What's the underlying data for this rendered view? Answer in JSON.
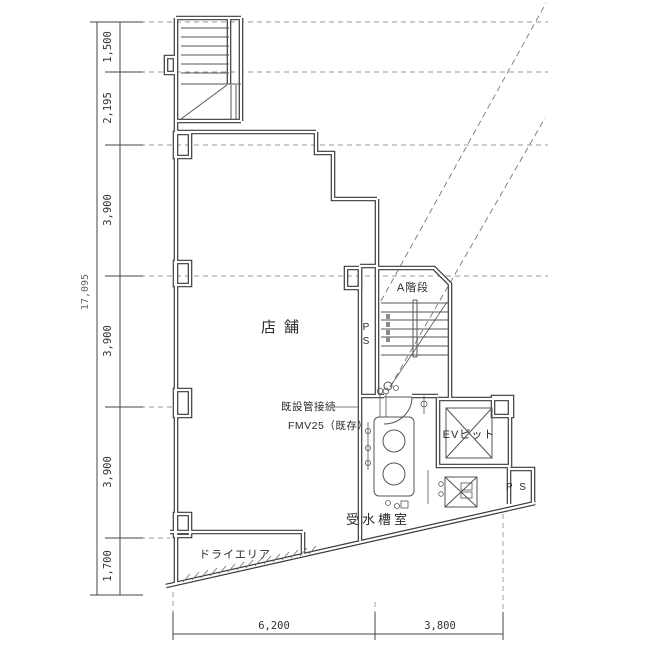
{
  "plan": {
    "rooms": {
      "store": "店舗",
      "stair_a": "A階段",
      "ev_pit": "EVピット",
      "ps_shaft": "PS",
      "ps_room": "P S",
      "water_tank_room": "受水槽室",
      "dry_area": "ドライエリア"
    },
    "annotations": {
      "pipe_connection": "既設管接続",
      "pipe_spec": "FMV25（既存）"
    },
    "dimensions": {
      "left_segments": [
        "1,500",
        "2,195",
        "3,900",
        "3,900",
        "3,900",
        "1,700"
      ],
      "left_total": "17,095",
      "bottom_segments": [
        "6,200",
        "3,800"
      ]
    },
    "colors": {
      "wall": "#3a3a3a",
      "thin_line": "#555555",
      "dashed_line": "#9a9a9a",
      "text": "#2b2b2b",
      "background": "#ffffff"
    }
  }
}
